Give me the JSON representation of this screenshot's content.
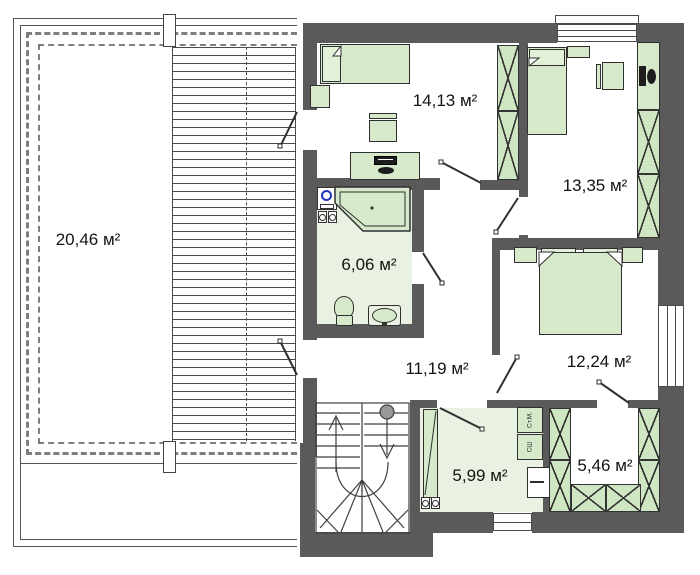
{
  "plan": {
    "type": "floor-plan",
    "unit": "м²",
    "rooms": [
      {
        "name": "terrace",
        "area_label": "20,46 м²"
      },
      {
        "name": "bedroom-top",
        "area_label": "14,13 м²"
      },
      {
        "name": "bedroom-right",
        "area_label": "13,35 м²"
      },
      {
        "name": "bathroom",
        "area_label": "6,06 м²"
      },
      {
        "name": "hallway",
        "area_label": "11,19 м²"
      },
      {
        "name": "bedroom-master",
        "area_label": "12,24 м²"
      },
      {
        "name": "laundry",
        "area_label": "5,99 м²"
      },
      {
        "name": "walk-in-closet",
        "area_label": "5,46 м²"
      }
    ],
    "appliances": {
      "washer_label": "Ст.М.",
      "dryer_label": "СШ"
    },
    "colors": {
      "wall": "#5a5a5a",
      "furniture_green": "#d6e9ca",
      "wardrobe_green": "#cfe6c2",
      "floor_tint": "#e9f1e2",
      "outline": "#2f2f2f",
      "washer_blue": "#2233bb"
    }
  }
}
